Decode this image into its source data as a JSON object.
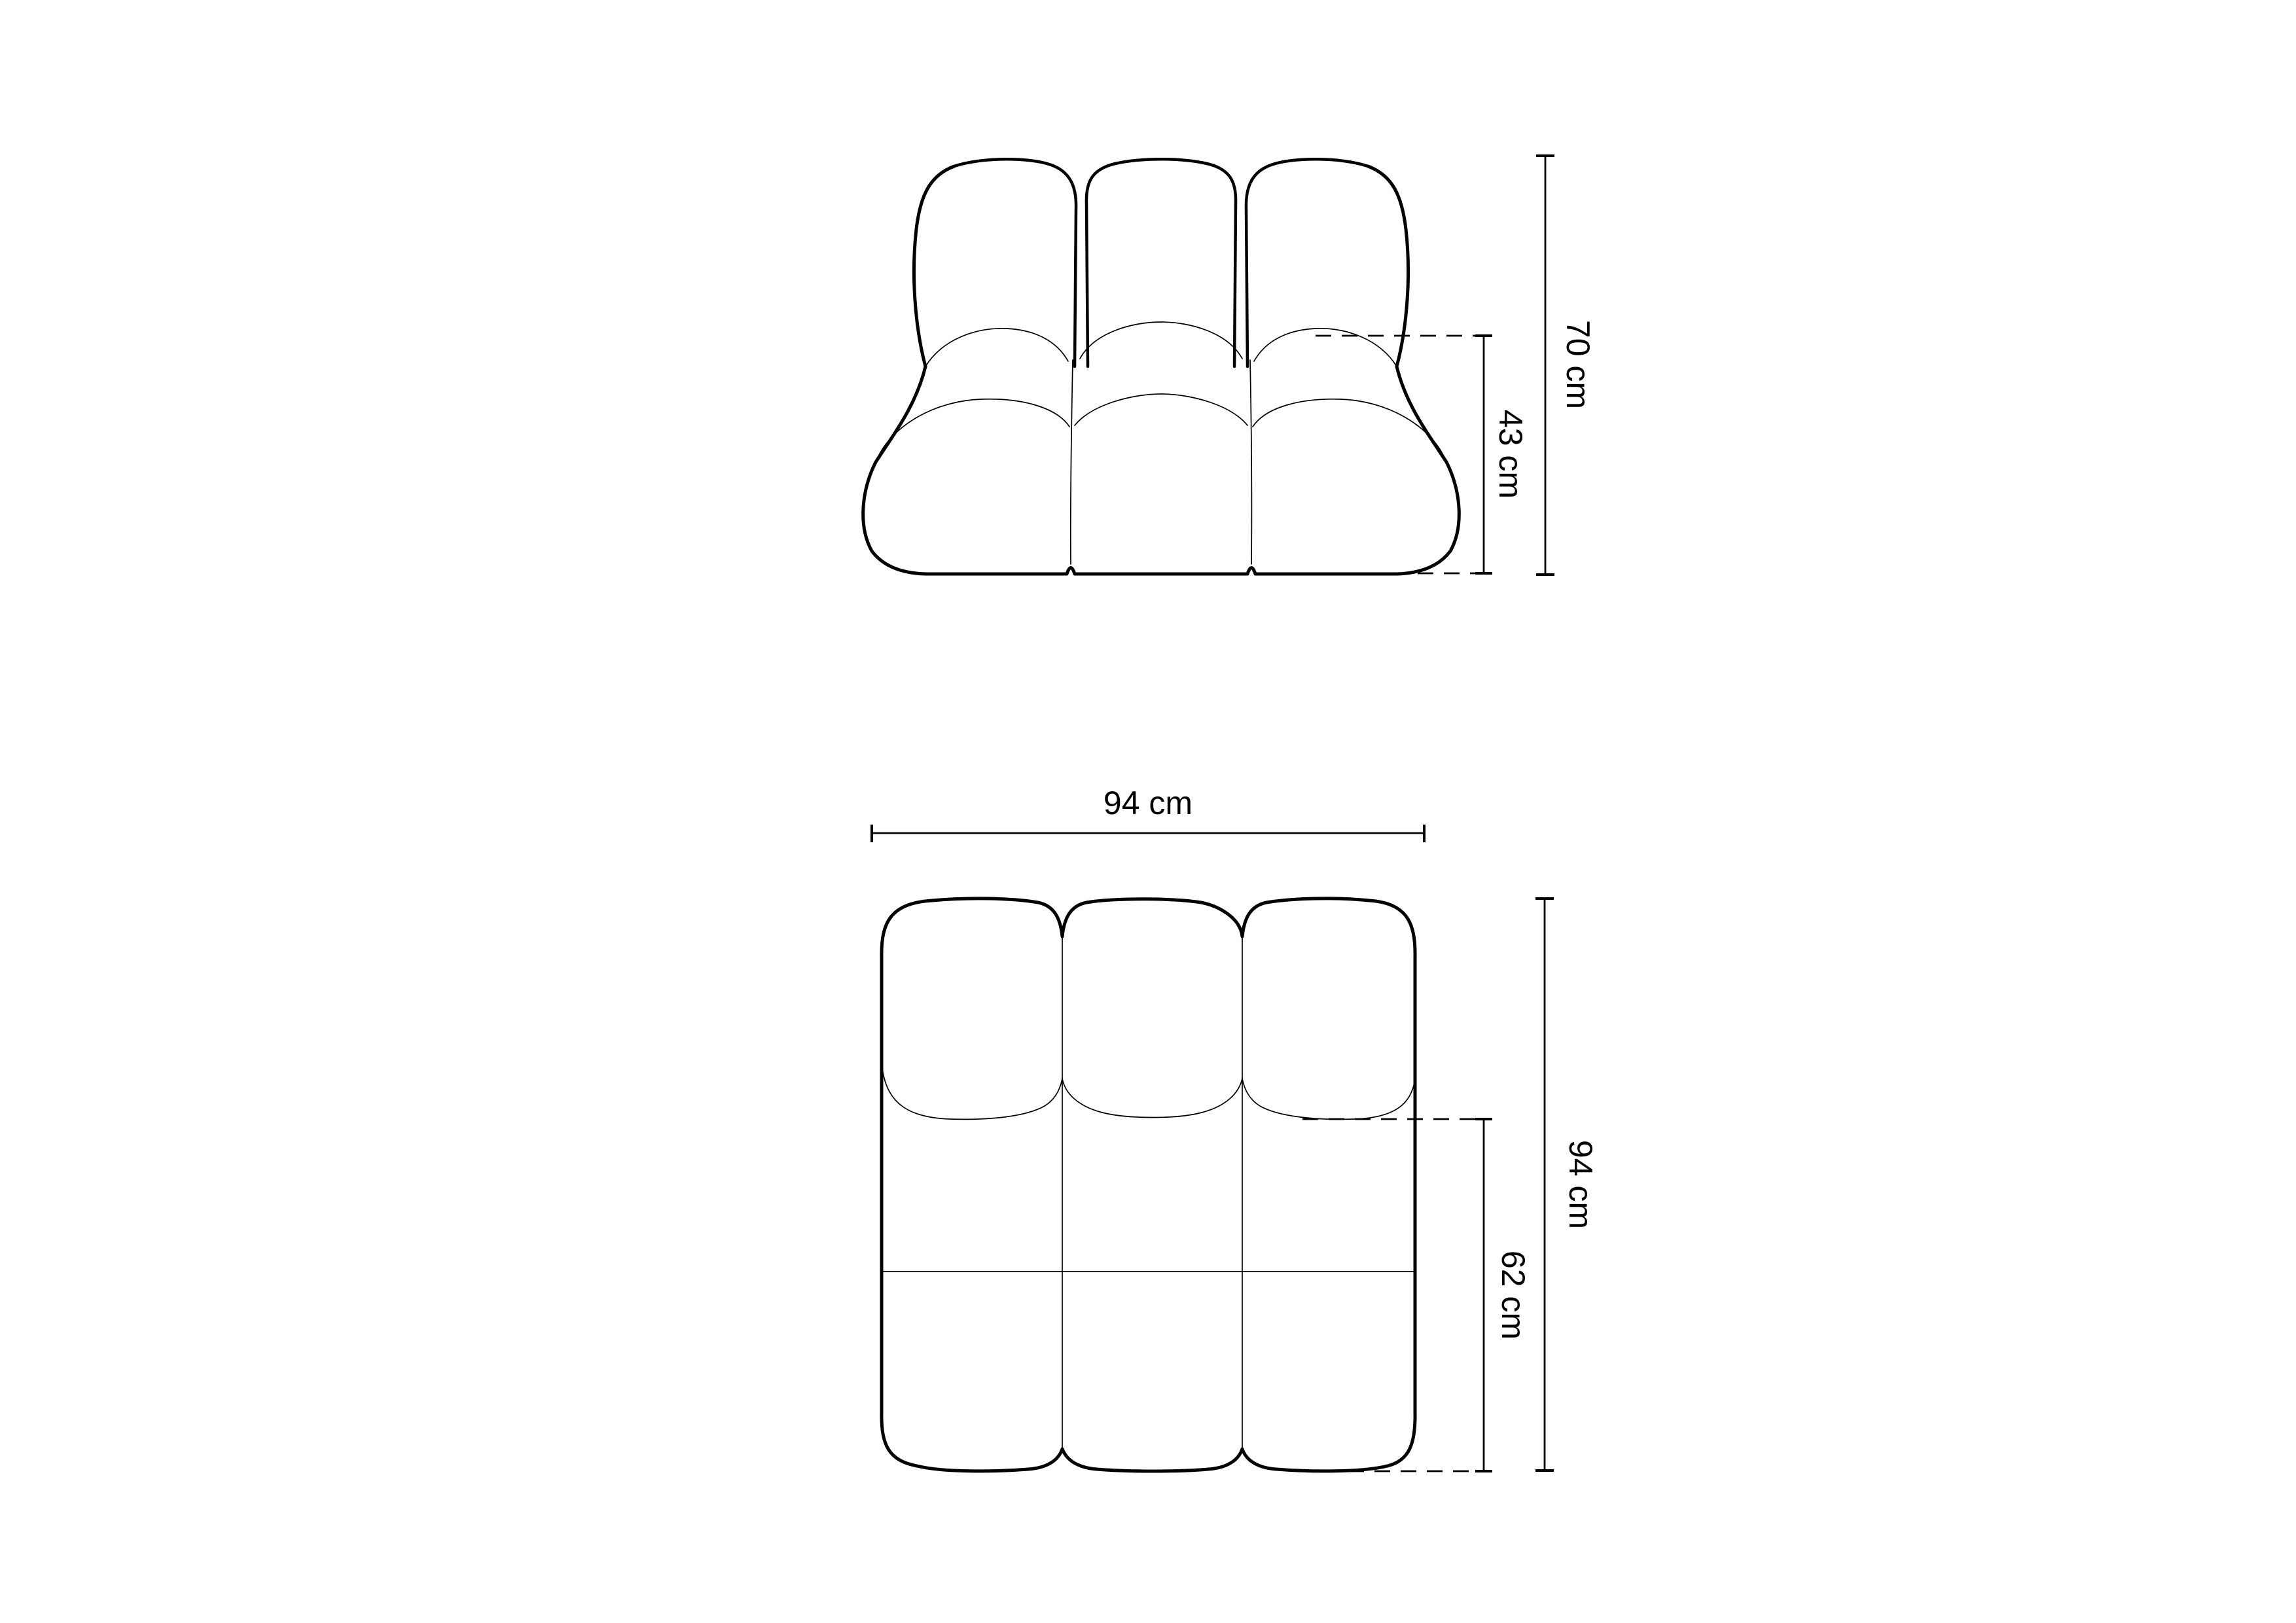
{
  "page": {
    "background_color": "#ffffff",
    "line_color": "#000000",
    "description": "Technical dimension drawing of a modular tufted armchair module, front elevation and top plan views"
  },
  "front_view": {
    "view_name": "front-elevation",
    "dim_total_height": "70 cm",
    "dim_seat_height": "43 cm"
  },
  "plan_view": {
    "view_name": "top-plan",
    "dim_width": "94 cm",
    "dim_depth": "94 cm",
    "dim_seat_depth": "62 cm"
  }
}
